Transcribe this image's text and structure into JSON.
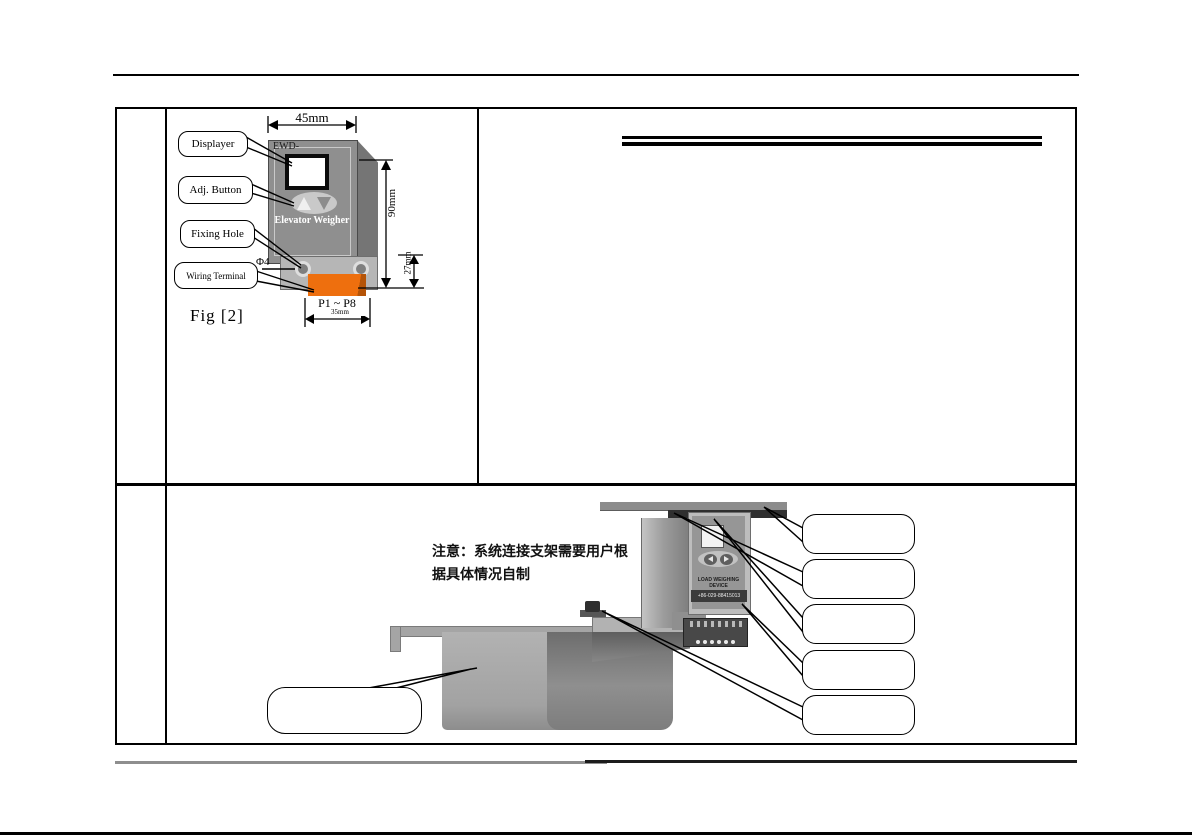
{
  "fig2": {
    "caption": "Fig [2]",
    "callouts": {
      "displayer": "Displayer",
      "adj_button": "Adj. Button",
      "fixing_hole": "Fixing Hole",
      "wiring_terminal": "Wiring Terminal"
    },
    "device": {
      "model_prefix": "EWD-",
      "product_name": "Elevator Weigher",
      "terminal_range": "P1 ~ P8"
    },
    "dimensions": {
      "top_width": "45mm",
      "body_height": "90mm",
      "flange_height": "27mm",
      "hole_diameter": "Φ4",
      "terminal_width": "35mm"
    }
  },
  "install_figure": {
    "note_line1": "注意：系统连接支架需要用户根",
    "note_line2": "据具体情况自制",
    "device_label_line1": "LOAD WEIGHING DEVICE",
    "device_label_line2": "+86-029-88415013"
  },
  "colors": {
    "device_body": "#8f8f8f",
    "device_side": "#757575",
    "flange": "#b6b6b6",
    "terminal_orange": "#ee6f0e",
    "dark_bar": "#2f2f2f",
    "line_black": "#000000"
  }
}
